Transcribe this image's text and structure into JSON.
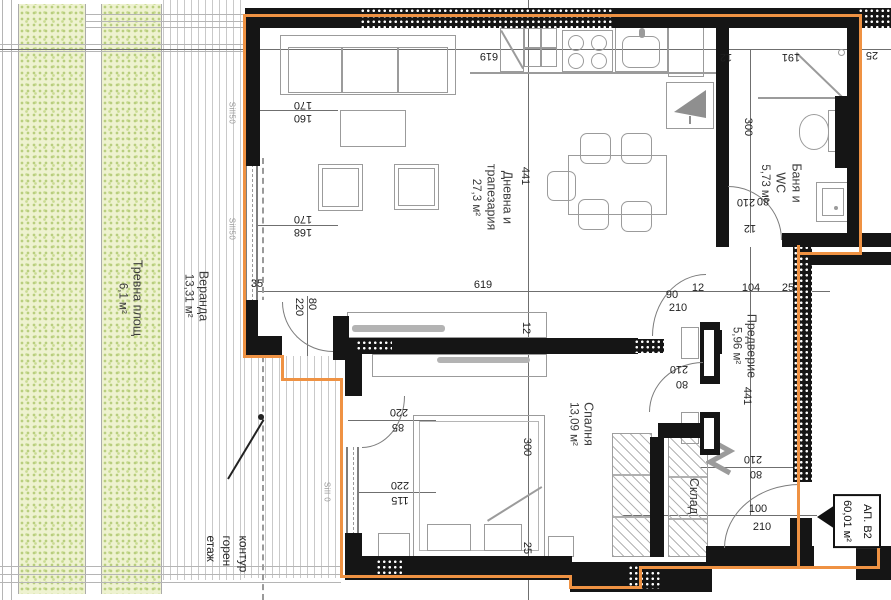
{
  "plan_title": {
    "unit": "АП. В2",
    "area": "60,01 м²"
  },
  "note": "контур\nгорен етаж",
  "rooms": [
    {
      "name": "Дневна и\nтрапезария",
      "area": "27,3 м²"
    },
    {
      "name": "Спалня",
      "area": "13,09 м²"
    },
    {
      "name": "Баня и\nWC",
      "area": "5,73 м²"
    },
    {
      "name": "Предверие",
      "area": "5,96 м²"
    },
    {
      "name": "Склад",
      "area": ""
    },
    {
      "name": "Веранда",
      "area": "13,31 м²"
    },
    {
      "name": "Тревна площ",
      "area": "6,1 м²"
    }
  ],
  "colors": {
    "wall": "#151515",
    "contour": "#ef9243",
    "furniture": "#9b9b9b",
    "grass": "#eef2d0"
  },
  "annotations": [
    {
      "t": "619",
      "x": 489,
      "y": 56,
      "o": "ud"
    },
    {
      "t": "170",
      "x": 303,
      "y": 105,
      "o": "ud"
    },
    {
      "t": "160",
      "x": 303,
      "y": 118,
      "o": "ud"
    },
    {
      "t": "170",
      "x": 303,
      "y": 219,
      "o": "ud"
    },
    {
      "t": "168",
      "x": 303,
      "y": 232,
      "o": "ud"
    },
    {
      "t": "12",
      "x": 726,
      "y": 57,
      "o": "ud"
    },
    {
      "t": "191",
      "x": 791,
      "y": 57,
      "o": "ud"
    },
    {
      "t": "25",
      "x": 872,
      "y": 55,
      "o": "ud"
    },
    {
      "t": "210",
      "x": 679,
      "y": 369,
      "o": "ud"
    },
    {
      "t": "80",
      "x": 682,
      "y": 384,
      "o": "ud"
    },
    {
      "t": "210",
      "x": 746,
      "y": 202,
      "o": "ud"
    },
    {
      "t": "80",
      "x": 763,
      "y": 201,
      "o": "ud"
    },
    {
      "t": "12",
      "x": 750,
      "y": 228,
      "o": "ud"
    },
    {
      "t": "220",
      "x": 399,
      "y": 412,
      "o": "ud"
    },
    {
      "t": "85",
      "x": 398,
      "y": 427,
      "o": "ud"
    },
    {
      "t": "220",
      "x": 400,
      "y": 485,
      "o": "ud"
    },
    {
      "t": "115",
      "x": 400,
      "y": 500,
      "o": "ud"
    },
    {
      "t": "210",
      "x": 753,
      "y": 459,
      "o": "ud"
    },
    {
      "t": "80",
      "x": 756,
      "y": 474,
      "o": "ud"
    },
    {
      "t": "619",
      "x": 483,
      "y": 285,
      "o": "up"
    },
    {
      "t": "90",
      "x": 672,
      "y": 295,
      "o": "up"
    },
    {
      "t": "210",
      "x": 678,
      "y": 308,
      "o": "up"
    },
    {
      "t": "12",
      "x": 698,
      "y": 288,
      "o": "up"
    },
    {
      "t": "104",
      "x": 751,
      "y": 288,
      "o": "up"
    },
    {
      "t": "25",
      "x": 788,
      "y": 288,
      "o": "up"
    },
    {
      "t": "35",
      "x": 257,
      "y": 284,
      "o": "up"
    },
    {
      "t": "100",
      "x": 758,
      "y": 509,
      "o": "up"
    },
    {
      "t": "210",
      "x": 762,
      "y": 527,
      "o": "up"
    },
    {
      "t": "441",
      "x": 525,
      "y": 176,
      "o": "v"
    },
    {
      "t": "12",
      "x": 526,
      "y": 328,
      "o": "v"
    },
    {
      "t": "300",
      "x": 527,
      "y": 447,
      "o": "v"
    },
    {
      "t": "25",
      "x": 527,
      "y": 548,
      "o": "v"
    },
    {
      "t": "300",
      "x": 748,
      "y": 127,
      "o": "v"
    },
    {
      "t": "441",
      "x": 747,
      "y": 396,
      "o": "v"
    },
    {
      "t": "220",
      "x": 299,
      "y": 307,
      "o": "v"
    },
    {
      "t": "80",
      "x": 312,
      "y": 304,
      "o": "v"
    },
    {
      "t": "Sill50",
      "x": 232,
      "y": 113,
      "o": "v",
      "c": "sill"
    },
    {
      "t": "Sill50",
      "x": 232,
      "y": 229,
      "o": "v",
      "c": "sill"
    },
    {
      "t": "Sill 0",
      "x": 327,
      "y": 492,
      "o": "v",
      "c": "sill"
    }
  ]
}
